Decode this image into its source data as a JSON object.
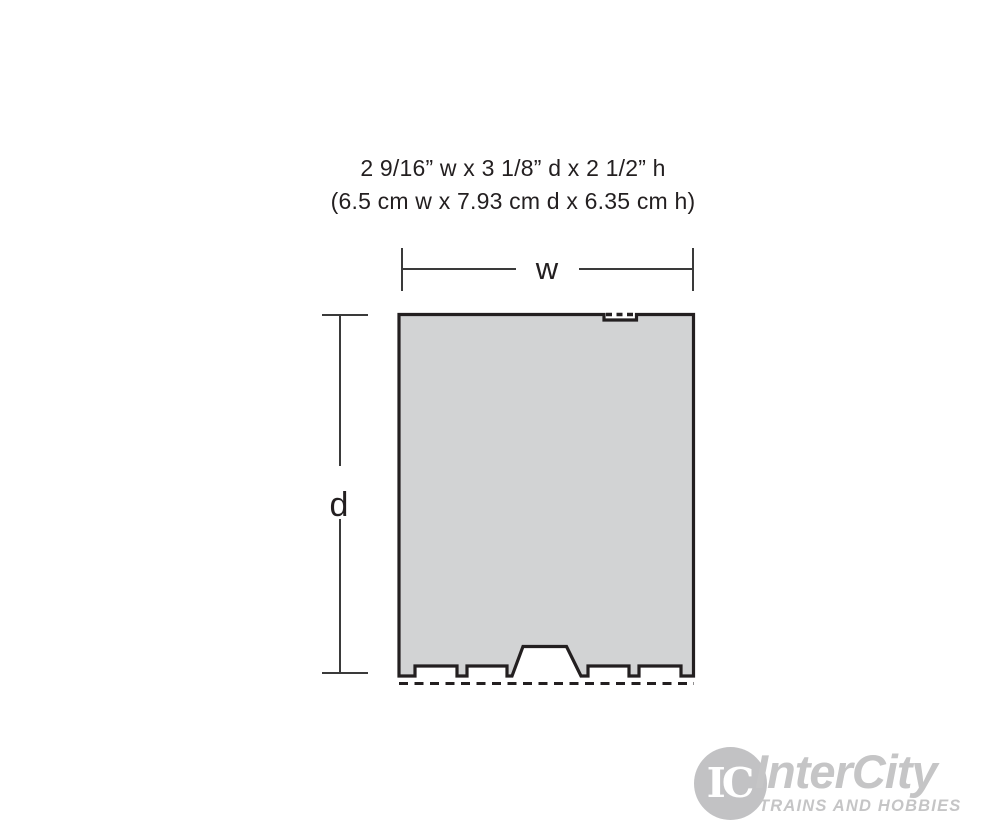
{
  "product_dimensions": {
    "imperial": "2 9/16” w x 3 1/8” d x 2 1/2” h",
    "metric": "(6.5 cm w x 7.93 cm d x 6.35 cm h)"
  },
  "diagram": {
    "width_label": "w",
    "depth_label": "d",
    "footprint_fill": "#d2d3d4",
    "outline_color": "#231f20",
    "dimension_line_color": "#3a3a3a"
  },
  "logo": {
    "monogram": "IC",
    "name": "InterCity",
    "tagline": "TRAINS AND HOBBIES",
    "brand_color": "#c5c5c6"
  }
}
